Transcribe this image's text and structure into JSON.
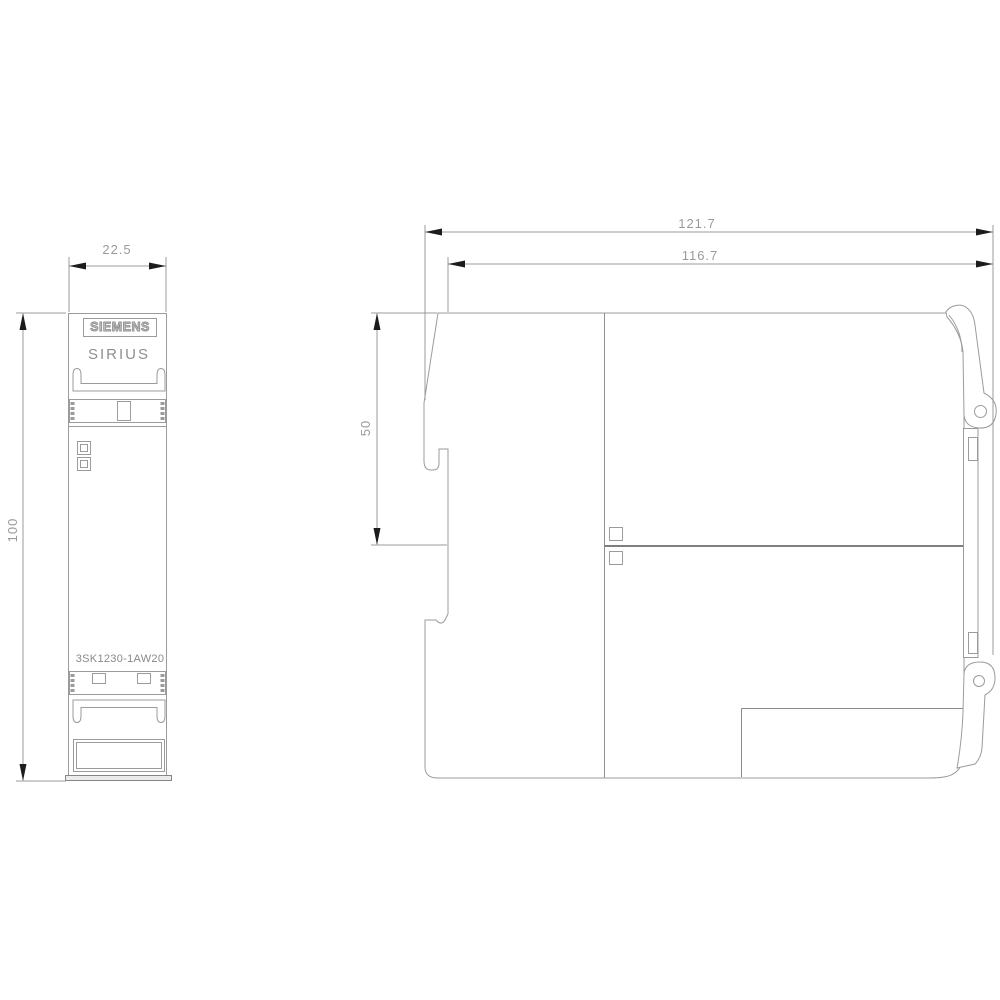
{
  "drawing": {
    "title": "dimension-drawing",
    "front_view": {
      "brand": "SIEMENS",
      "product_line": "SIRIUS",
      "part_number": "3SK1230-1AW20",
      "width_mm": "22.5",
      "height_mm": "100"
    },
    "side_view": {
      "overall_width_mm": "121.7",
      "housing_width_mm": "116.7",
      "upper_section_height_mm": "50"
    },
    "colors": {
      "line": "#9b9b9b",
      "dark_line": "#7f7f7f",
      "arrow": "#1c1c1c",
      "text": "#9a9a9a",
      "background": "#ffffff"
    }
  }
}
